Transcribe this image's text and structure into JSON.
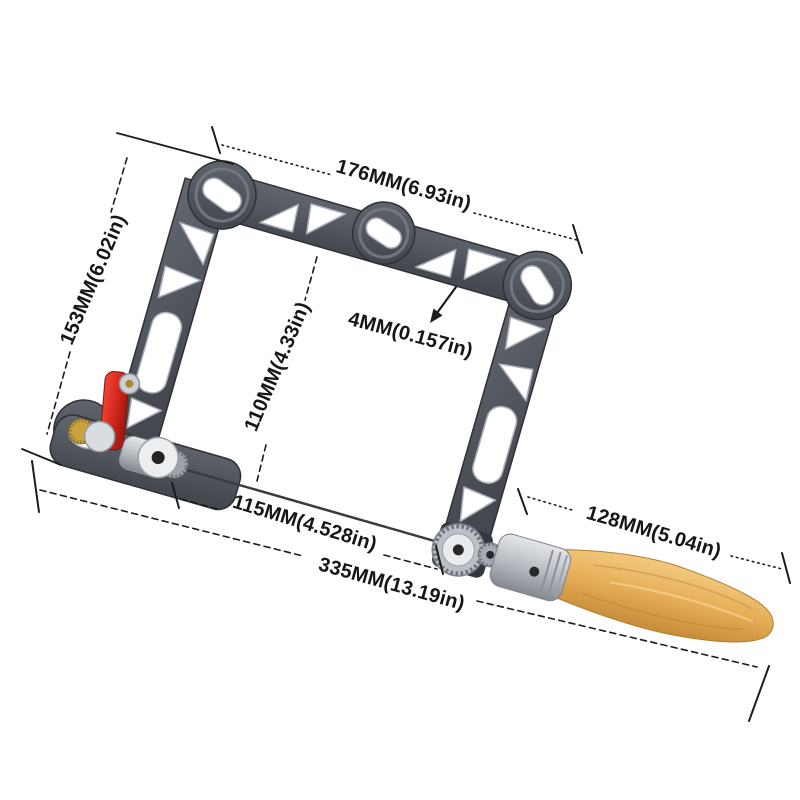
{
  "background": "#ffffff",
  "product": {
    "name": "coping saw with wooden handle",
    "view": "angled product photo with dimension callouts",
    "parts": {
      "frame": "aluminum saw frame with triangle and circle cutouts",
      "blade": "thin saw blade between clamps",
      "tension_lever": "red quick-release tension lever",
      "tension_knob": "brass knurled knob",
      "blade_clamp": "steel blade clamp barrel",
      "collar": "aluminum handle collar",
      "handle": "beech wood handle"
    }
  },
  "annotations": {
    "top_width": "176MM(6.93in)",
    "left_height": "153MM(6.02in)",
    "throat_depth": "110MM(4.33in)",
    "frame_thickness": "4MM(0.157in)",
    "blade_length": "115MM(4.528in)",
    "overall_length": "335MM(13.19in)",
    "handle_length": "128MM(5.04in)"
  },
  "colors": {
    "frame_gray": "#53575f",
    "frame_edge": "#2e3136",
    "cutout_bevel": "#a9afb7",
    "lever_red": "#d5281e",
    "brass": "#caa33e",
    "steel_silver": "#c5c9cf",
    "wood_tan": "#e7b766",
    "dimension_ink": "#1c1c1c"
  }
}
